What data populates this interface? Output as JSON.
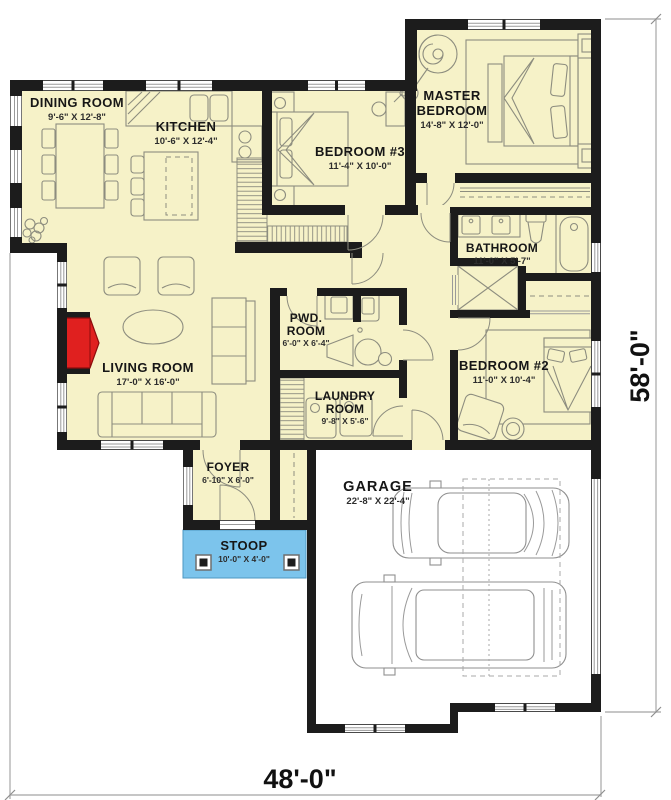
{
  "title": "House floor plan",
  "rooms": {
    "dining": {
      "name": "DINING ROOM",
      "dims": "9'-6\" X 12'-8\""
    },
    "kitchen": {
      "name": "KITCHEN",
      "dims": "10'-6\" X 12'-4\""
    },
    "bedroom3": {
      "name": "BEDROOM #3",
      "dims": "11'-4\" X 10'-0\""
    },
    "master": {
      "name_line1": "MASTER",
      "name_line2": "BEDROOM",
      "dims": "14'-8\" X 12'-0\""
    },
    "bathroom": {
      "name": "BATHROOM",
      "dims": "11'-0\" X 5'-7\""
    },
    "bedroom2": {
      "name": "BEDROOM #2",
      "dims": "11'-0\" X 10'-4\""
    },
    "living": {
      "name": "LIVING ROOM",
      "dims": "17'-0\" X 16'-0\""
    },
    "pwd": {
      "name_line1": "PWD.",
      "name_line2": "ROOM",
      "dims": "6'-0\" X 6'-4\""
    },
    "laundry": {
      "name_line1": "LAUNDRY",
      "name_line2": "ROOM",
      "dims": "9'-8\" X 5'-6\""
    },
    "foyer": {
      "name": "FOYER",
      "dims": "6'-10\" X 6'-0\""
    },
    "stoop": {
      "name": "STOOP",
      "dims": "10'-0\" X 4'-0\""
    },
    "garage": {
      "name": "GARAGE",
      "dims": "22'-8\" X 22'-4\""
    }
  },
  "overall_dimensions": {
    "width": "48'-0\"",
    "height": "58'-0\""
  },
  "colors": {
    "floor": "#F6F2C8",
    "wall": "#1C1C1C",
    "stoop": "#7CC4EC",
    "fireplace": "#E0201F",
    "furniture_line": "#8D8D7F",
    "garage_floor": "#FFFFFF",
    "dimension_text": "#111111"
  }
}
